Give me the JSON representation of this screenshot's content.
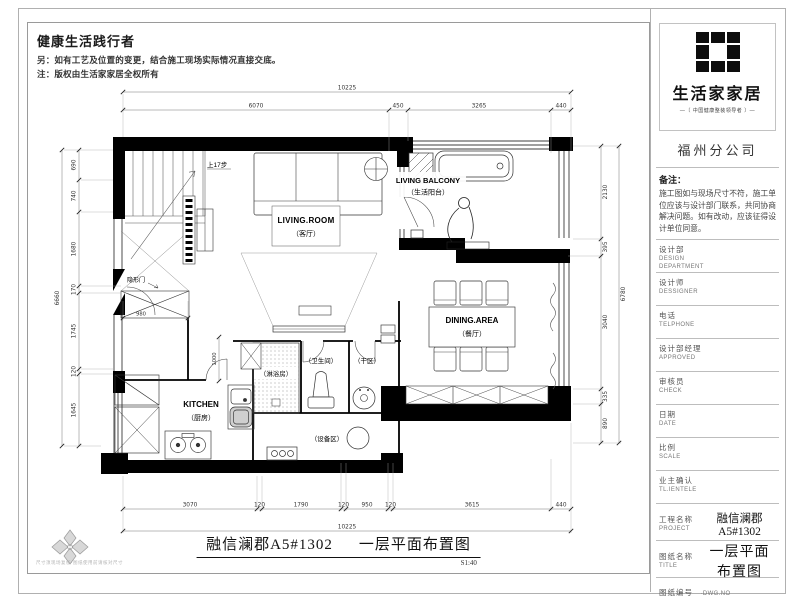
{
  "header": {
    "slogan": "健康生活践行者",
    "note1": "另：如有工艺及位置的变更，结合施工现场实际情况直接交底。",
    "note2": "注：版权由生活家家居全权所有"
  },
  "plan": {
    "rooms": {
      "living_en": "LIVING.ROOM",
      "living_cn": "（客厅）",
      "balcony_en": "LIVING BALCONY",
      "balcony_cn": "（生活阳台）",
      "dining_en": "DINING.AREA",
      "dining_cn": "（餐厅）",
      "kitchen_en": "KITCHEN",
      "kitchen_cn": "（厨房）",
      "shower_cn": "（淋浴房）",
      "toilet_cn": "（卫生间）",
      "dry_cn": "（干区）",
      "equip_cn": "（设备区）",
      "stairs": "上17步",
      "hidden_door": "隐形门"
    },
    "dims": {
      "t_total": "10225",
      "t1": "6070",
      "t2": "450",
      "t3": "3265",
      "t4": "440",
      "l_total": "6660",
      "l1": "690",
      "l2": "740",
      "l3": "1680",
      "l4": "170",
      "l5": "1745",
      "l6": "120",
      "l7": "1645",
      "r_total": "6780",
      "r1": "2130",
      "r2": "395",
      "r3": "3040",
      "r4": "335",
      "r5": "890",
      "b_total": "10225",
      "b1": "3070",
      "b2": "120",
      "b3": "1790",
      "b4": "120",
      "b5": "950",
      "b6": "120",
      "b7": "3615",
      "b8": "440",
      "closet": "980",
      "hall": "1000"
    }
  },
  "titlebar": {
    "project": "融信澜郡A5#1302",
    "drawing": "一层平面布置图",
    "scale": "S1:40"
  },
  "footer": {
    "fine_print": "尺寸须现场复核·图纸使用前请核对尺寸"
  },
  "sidebar": {
    "brand": "生活家家居",
    "tagline": "—〔 中国健康整装领导者 〕—",
    "branch": "福州分公司",
    "remark_title": "备注：",
    "remark_body": "施工图如与现场尺寸不符，施工单位应该与设计部门联系，共同协商解决问题。如有改动，应该征得设计单位同意。",
    "fields": [
      {
        "cn": "设计部",
        "en": "DESIGN DEPARTMENT",
        "value": ""
      },
      {
        "cn": "设计师",
        "en": "DESSIGNER",
        "value": ""
      },
      {
        "cn": "电话",
        "en": "TELPHONE",
        "value": ""
      },
      {
        "cn": "设计部经理",
        "en": "APPROVED",
        "value": ""
      },
      {
        "cn": "审核员",
        "en": "CHECK",
        "value": ""
      },
      {
        "cn": "日期",
        "en": "DATE",
        "value": ""
      },
      {
        "cn": "比例",
        "en": "SCALE",
        "value": ""
      },
      {
        "cn": "业主确认",
        "en": "TL.IENTELE",
        "value": ""
      },
      {
        "cn": "工程名称",
        "en": "PROJECT",
        "value": "融信澜郡A5#1302"
      },
      {
        "cn": "图纸名称",
        "en": "TITLE",
        "value": "一层平面布置图"
      },
      {
        "cn": "图纸编号",
        "en": "·DWG.NO",
        "value": ""
      }
    ]
  }
}
